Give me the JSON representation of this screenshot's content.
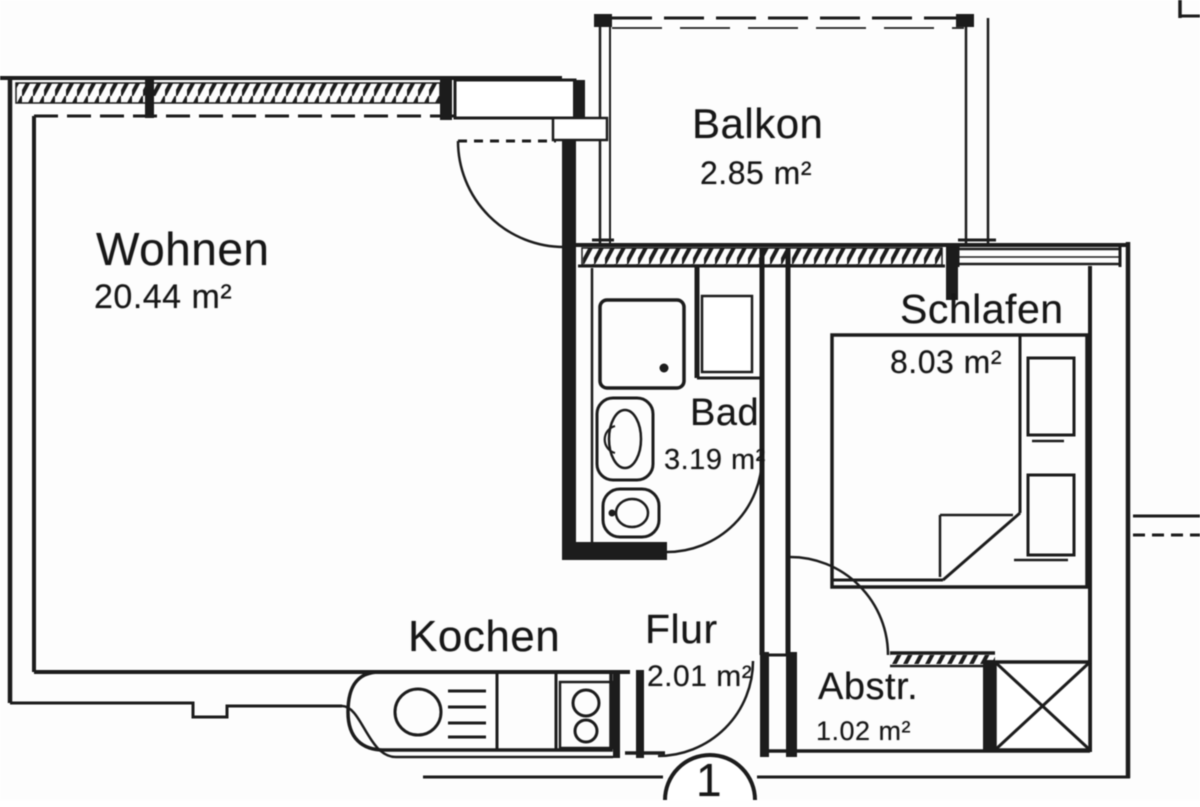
{
  "plan": {
    "type": "apartment-floor-plan",
    "rooms": [
      {
        "id": "wohnen",
        "name": "Wohnen",
        "area": "20.44 m²"
      },
      {
        "id": "balkon",
        "name": "Balkon",
        "area": "2.85 m²"
      },
      {
        "id": "bad",
        "name": "Bad",
        "area": "3.19 m²"
      },
      {
        "id": "schlafen",
        "name": "Schlafen",
        "area": "8.03 m²"
      },
      {
        "id": "kochen",
        "name": "Kochen"
      },
      {
        "id": "flur",
        "name": "Flur",
        "area": "2.01 m²"
      },
      {
        "id": "abstellraum",
        "name": "Abstr.",
        "area": "1.02 m²"
      }
    ],
    "floor_indicator": "1",
    "colors": {
      "line": "#1c1c1c",
      "background": "#fdfdfd"
    }
  }
}
